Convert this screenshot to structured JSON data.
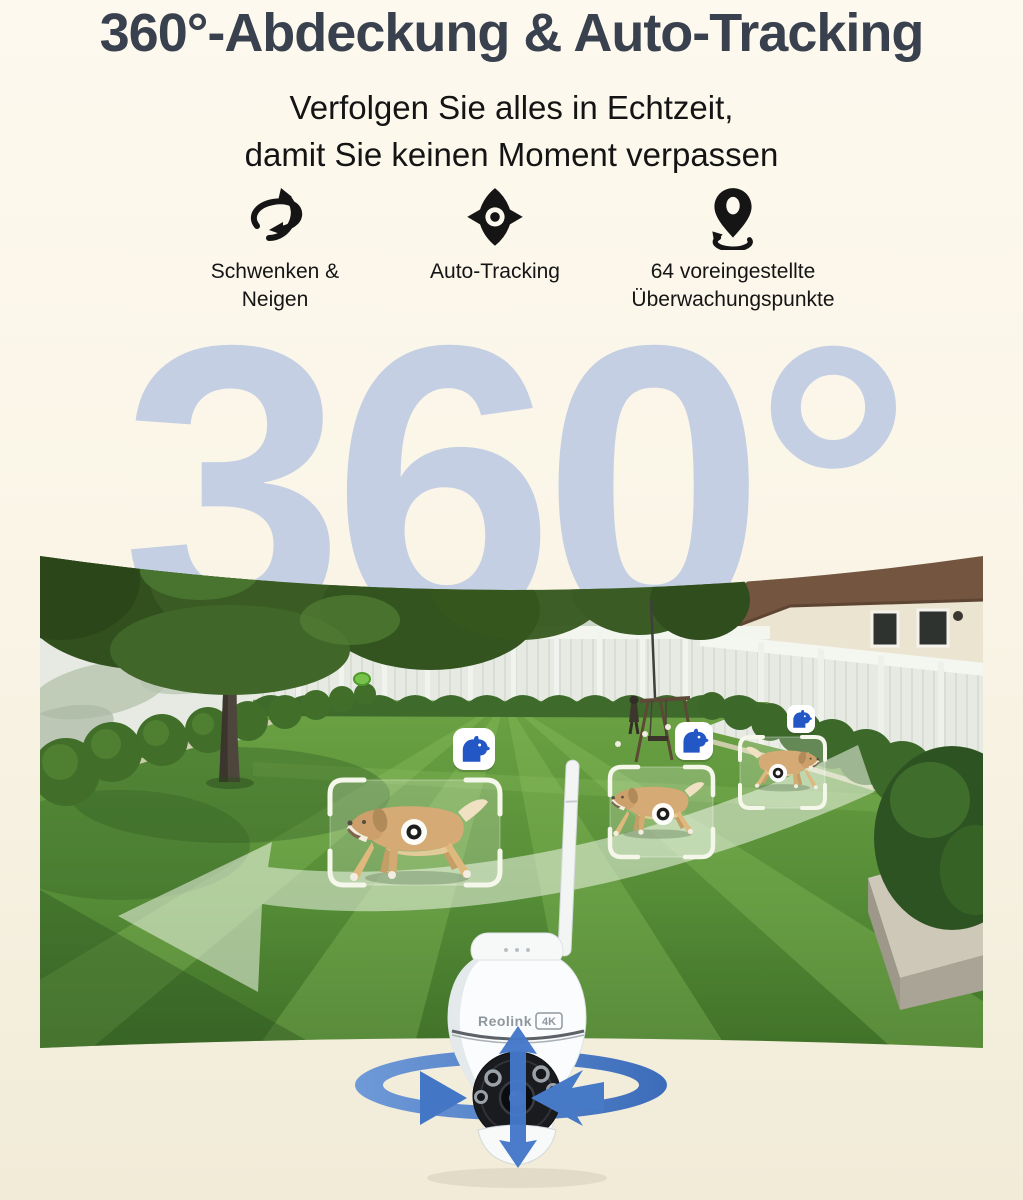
{
  "page": {
    "background_top": "#fdf9ee",
    "background_bottom": "#f1ebd8"
  },
  "header": {
    "title": "360°-Abdeckung & Auto-Tracking",
    "title_color": "#39414e",
    "subtitle_line1": "Verfolgen Sie alles in Echtzeit,",
    "subtitle_line2": "damit Sie keinen Moment verpassen"
  },
  "features": [
    {
      "icon": "pan-tilt-icon",
      "label_line1": "Schwenken &",
      "label_line2": "Neigen"
    },
    {
      "icon": "auto-tracking-icon",
      "label_line1": "Auto-Tracking",
      "label_line2": ""
    },
    {
      "icon": "preset-points-icon",
      "label_line1": "64 voreingestellte",
      "label_line2": "Überwachungspunkte"
    }
  ],
  "hero": {
    "big_text": "360",
    "degree_symbol": "°",
    "text_color": "#c4cfe4"
  },
  "scene": {
    "photo": "backyard-panorama",
    "detection_count": 3,
    "detection_subject": "dog",
    "badge_icon": "dog-icon",
    "badge_icon_color": "#2357c5",
    "bracket_color": "#f4f7ea",
    "track_arrow_color": "rgba(238,246,232,0.55)"
  },
  "camera": {
    "brand": "Reolink",
    "badge": "4K",
    "arrow_color": "#4478c9"
  }
}
